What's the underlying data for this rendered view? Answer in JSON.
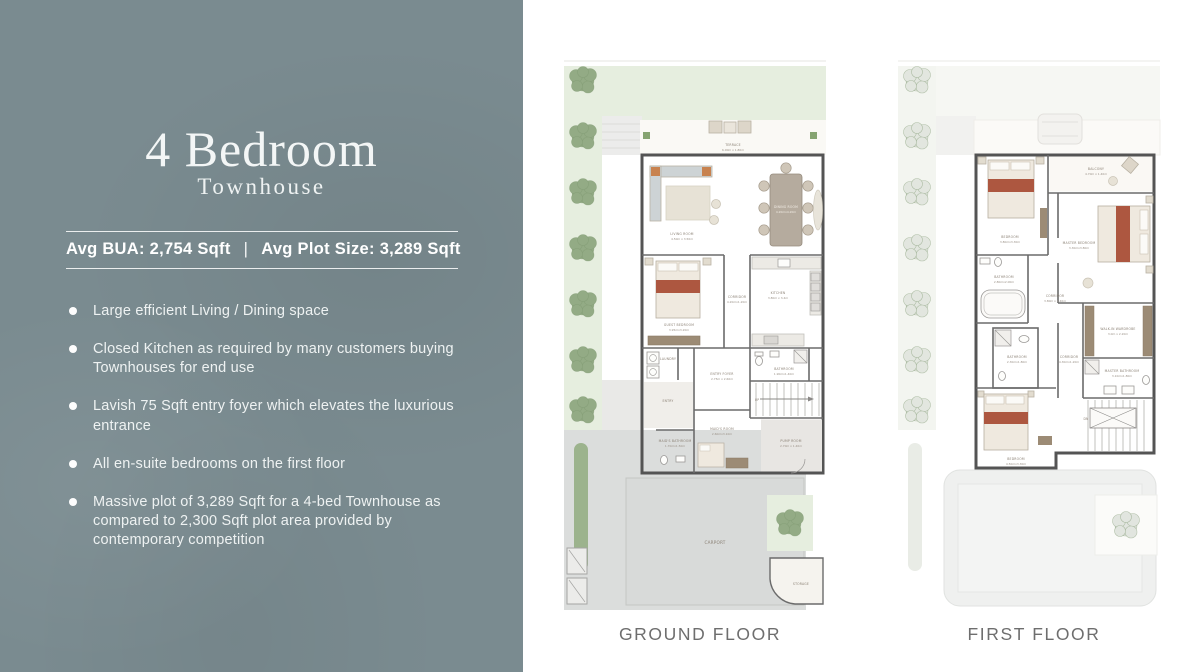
{
  "panel": {
    "title": "4 Bedroom",
    "subtitle": "Townhouse",
    "stats": {
      "bua": "Avg BUA: 2,754 Sqft",
      "separator": "|",
      "plot": "Avg Plot Size: 3,289 Sqft"
    },
    "bullets": [
      "Large efficient Living / Dining space",
      "Closed Kitchen as required by many customers buying Townhouses for end use",
      "Lavish 75 Sqft entry foyer which elevates the luxurious entrance",
      "All en-suite bedrooms on the first floor",
      "Massive plot of 3,289 Sqft for a 4-bed Townhouse as compared to 2,300 Sqft plot area provided by contemporary competition"
    ]
  },
  "plans": {
    "ground": {
      "caption": "GROUND FLOOR",
      "stairs_label": "UP",
      "rooms": [
        {
          "name": "TERRACE",
          "dims": "6.00m x 1.80m"
        },
        {
          "name": "LIVING ROOM",
          "dims": "4.50m x 3.50m"
        },
        {
          "name": "DINING ROOM",
          "dims": "4.20mx4.20m"
        },
        {
          "name": "GUEST BEDROOM",
          "dims": "3.95mx3.20m"
        },
        {
          "name": "CORRIDOR",
          "dims": "4.20mx1.20m"
        },
        {
          "name": "KITCHEN",
          "dims": "3.80m x 3.4m"
        },
        {
          "name": "BATHROOM",
          "dims": "1.90mx1.40m"
        },
        {
          "name": "LAUNDRY",
          "dims": ""
        },
        {
          "name": "ENTRY FOYER",
          "dims": "2.75m x 2.60m"
        },
        {
          "name": "ENTRY",
          "dims": ""
        },
        {
          "name": "MAID'S BATHROOM",
          "dims": "1.70mx1.50m"
        },
        {
          "name": "MAID'S ROOM",
          "dims": "2.60mx3.10m"
        },
        {
          "name": "PUMP ROOM",
          "dims": "2.70m x 1.40m"
        },
        {
          "name": "CARPORT",
          "dims": ""
        },
        {
          "name": "STORAGE",
          "dims": ""
        }
      ]
    },
    "first": {
      "caption": "FIRST FLOOR",
      "stairs_label": "DN",
      "rooms": [
        {
          "name": "BALCONY",
          "dims": "4.70m x 1.40m"
        },
        {
          "name": "BEDROOM",
          "dims": "3.80mx3.30m"
        },
        {
          "name": "MASTER BEDROOM",
          "dims": "3.30mx3.80m"
        },
        {
          "name": "BATHROOM",
          "dims": "2.80mx2.00m"
        },
        {
          "name": "CORRIDOR",
          "dims": "3.80m x 1.40m"
        },
        {
          "name": "WALK-IN WARDROBE",
          "dims": "3.0m x 2.20m"
        },
        {
          "name": "BATHROOM",
          "dims": "2.30mx1.80m"
        },
        {
          "name": "MASTER BATHROOM",
          "dims": "3.10mx1.80m"
        },
        {
          "name": "CORRIDOR",
          "dims": "4.30mx1.20m"
        },
        {
          "name": "BEDROOM",
          "dims": "4.50mx3.30m"
        }
      ]
    }
  },
  "colors": {
    "panel_bg": "#7a8b90",
    "panel_text": "#eef2f2",
    "plan_wall": "#545454",
    "lawn_green": "#e6eedf",
    "tree_green": "#93ab85",
    "bed_accent": "#ad5740",
    "paving_gray": "#dbdddc",
    "caption_gray": "#6e6e6e"
  }
}
